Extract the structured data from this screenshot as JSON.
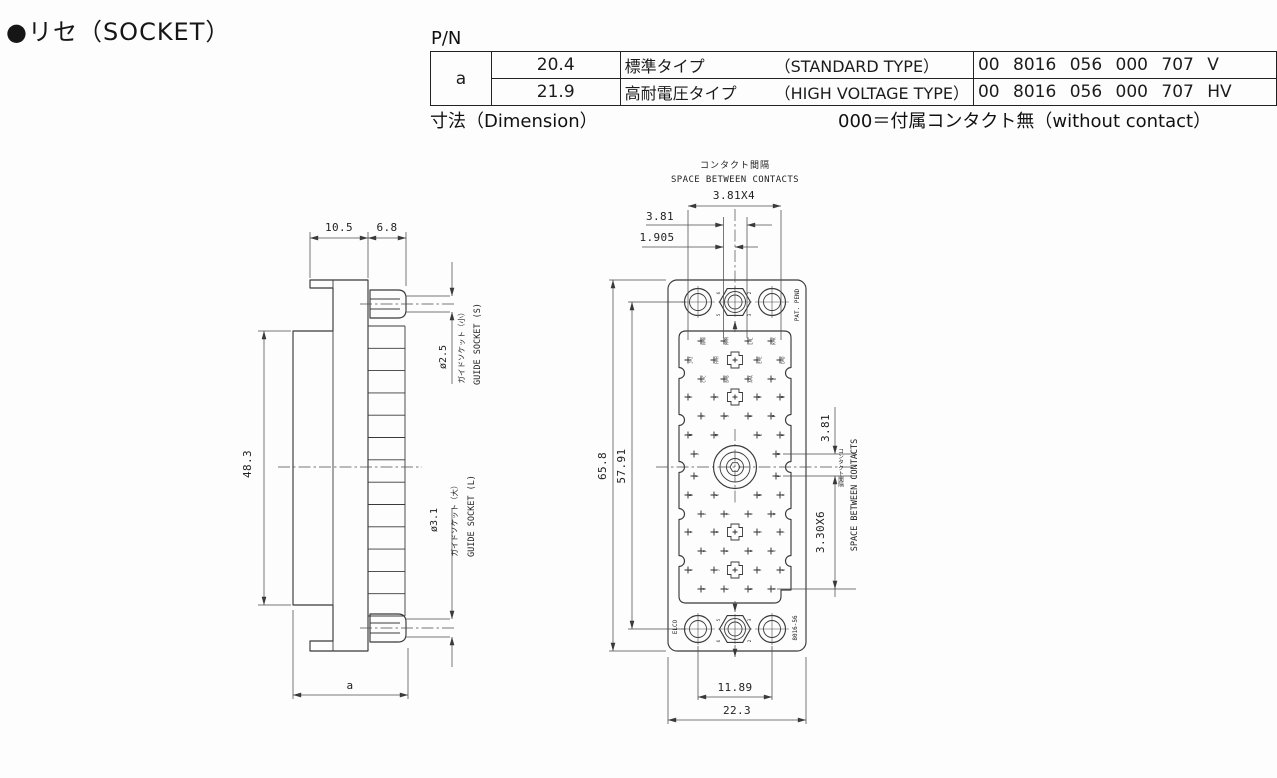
{
  "title": "●リセ（SOCKET）",
  "table": {
    "pn_label": "P/N",
    "row_header": "a",
    "rows": [
      {
        "dim": "20.4",
        "type_jp": "標準タイプ",
        "type_en": "（STANDARD TYPE）",
        "pn": "00 8016 056 000 707 V"
      },
      {
        "dim": "21.9",
        "type_jp": "高耐電圧タイプ",
        "type_en": "（HIGH VOLTAGE TYPE）",
        "pn": "00 8016 056 000 707 HV"
      }
    ],
    "dimension_label": "寸法（Dimension）",
    "note": "000＝付属コンタクト無（without contact）"
  },
  "side_view": {
    "dim_10_5": "10.5",
    "dim_6_8": "6.8",
    "dim_48_3": "48.3",
    "dim_a": "a",
    "guide_small_dia": "ø2.5",
    "guide_small_jp": "ガイドソケット（小）",
    "guide_small_en": "GUIDE SOCKET (S)",
    "guide_large_dia": "ø3.1",
    "guide_large_jp": "ガイドソケット（大）",
    "guide_large_en": "GUIDE SOCKET (L)"
  },
  "front_view": {
    "labels": {
      "space_jp_top": "コンタクト間隔",
      "space_en_top": "SPACE BETWEEN CONTACTS",
      "dim_3_81x4": "3.81X4",
      "dim_3_81_top": "3.81",
      "dim_1_905": "1.905",
      "dim_65_8": "65.8",
      "dim_57_91": "57.91",
      "dim_3_81_right": "3.81",
      "dim_3_30x6": "3.30X6",
      "space_jp_side": "コンタクト間隔",
      "space_en_side": "SPACE BETWEEN CONTACTS",
      "dim_11_89": "11.89",
      "dim_22_3": "22.3",
      "pat_pend": "PAT. PEND",
      "brand": "ELCO",
      "model": "8016-56"
    },
    "contacts": {
      "row_y": [
        341,
        360,
        379,
        397,
        416,
        435,
        454,
        476,
        495,
        514,
        532,
        551,
        570,
        589
      ],
      "patterns": {
        "A": [
          701,
          724,
          748,
          771
        ],
        "B": [
          688,
          714,
          757,
          780
        ],
        "T": [
          694,
          776
        ]
      },
      "rows": [
        {
          "p": "A",
          "labels": [
            "NN",
            "MM",
            "LL",
            "KK"
          ]
        },
        {
          "p": "B",
          "labels": [
            "JJ",
            "HH",
            "EE",
            "DD"
          ],
          "hex": true
        },
        {
          "p": "A",
          "labels": [
            "CC",
            "BB",
            "AA",
            "Z"
          ]
        },
        {
          "p": "B",
          "labels": [
            "Y",
            "X",
            "V",
            "U"
          ],
          "hex": true
        },
        {
          "p": "A",
          "labels": [
            "T",
            "S",
            "R",
            "P"
          ]
        },
        {
          "p": "B",
          "labels": [
            "N",
            "M",
            "L",
            "K"
          ]
        },
        {
          "p": "T",
          "labels": [
            "J",
            "H"
          ]
        },
        {
          "p": "T",
          "labels": [
            "F",
            "E"
          ]
        },
        {
          "p": "B",
          "labels": [
            "D",
            "C",
            "B",
            "A"
          ]
        },
        {
          "p": "A",
          "labels": [
            "z",
            "y",
            "x",
            "w"
          ]
        },
        {
          "p": "B",
          "labels": [
            "v",
            "u",
            "s",
            "r"
          ],
          "hex": true
        },
        {
          "p": "A",
          "labels": [
            "p",
            "n",
            "m",
            "l"
          ]
        },
        {
          "p": "B",
          "labels": [
            "k",
            "j",
            "f",
            "e"
          ],
          "hex": true
        },
        {
          "p": "A",
          "labels": [
            "d",
            "c",
            "b",
            "a"
          ]
        }
      ]
    },
    "hole_digits": [
      {
        "t": "6",
        "x": 720,
        "y": 293
      },
      {
        "t": "2",
        "x": 751,
        "y": 293
      },
      {
        "t": "5",
        "x": 720,
        "y": 315
      },
      {
        "t": "3",
        "x": 751,
        "y": 315
      },
      {
        "t": "5",
        "x": 720,
        "y": 620
      },
      {
        "t": "3",
        "x": 751,
        "y": 620
      },
      {
        "t": "6",
        "x": 720,
        "y": 641
      },
      {
        "t": "2",
        "x": 751,
        "y": 641
      }
    ]
  }
}
